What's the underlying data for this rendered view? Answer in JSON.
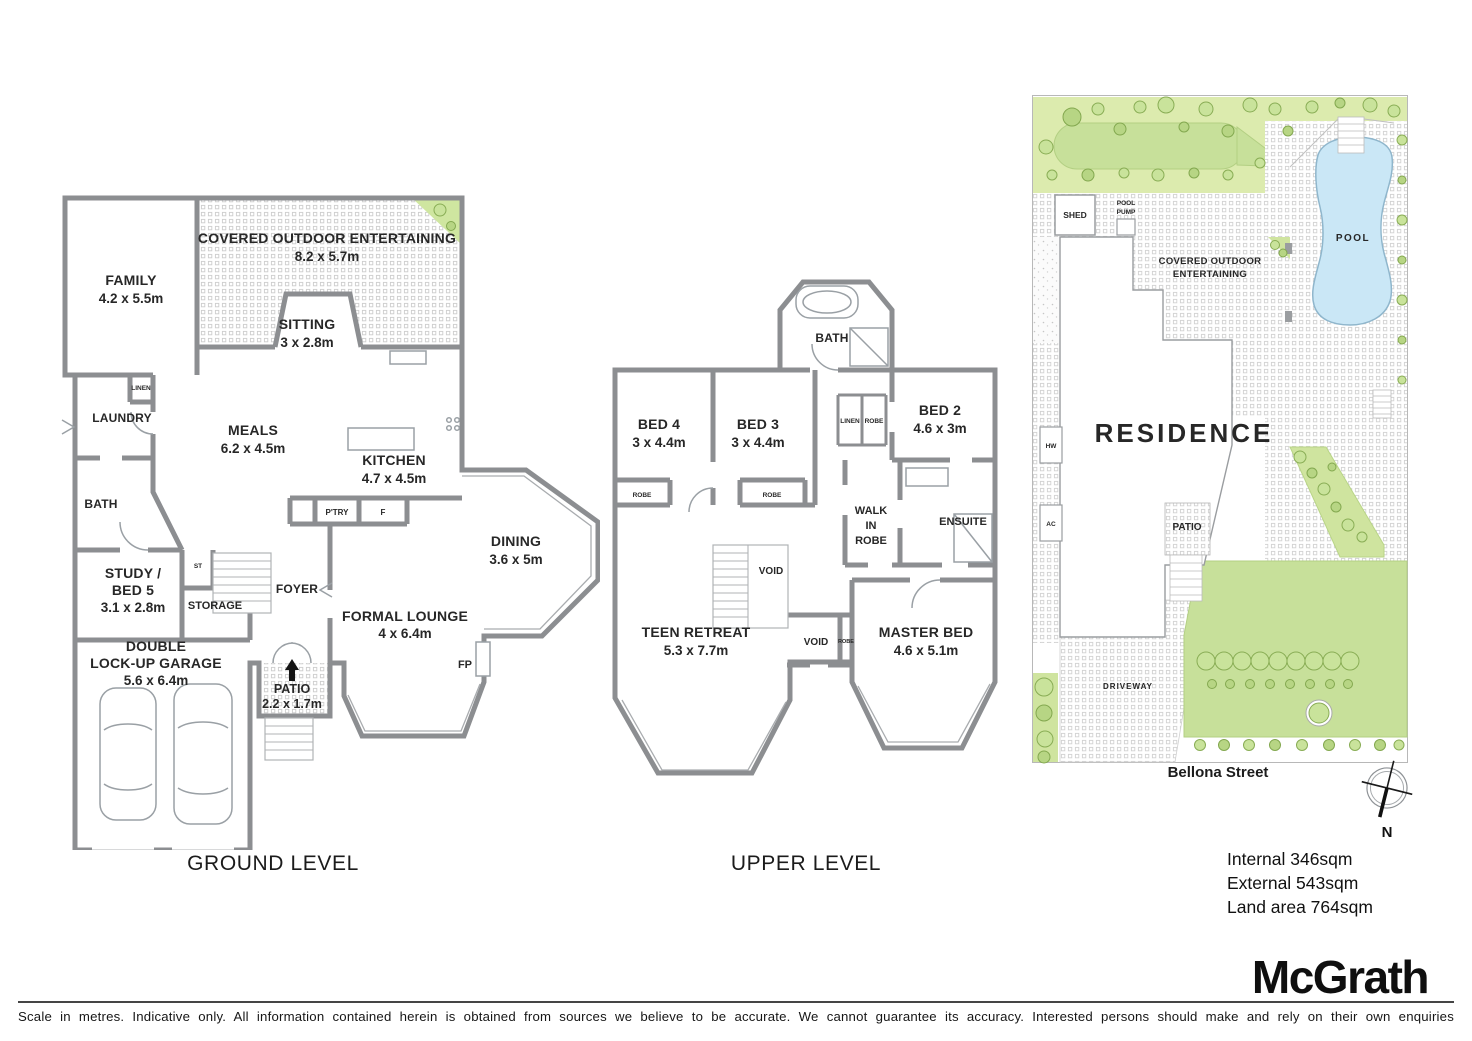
{
  "ground": {
    "title": "GROUND LEVEL",
    "rooms": {
      "family": {
        "name": "FAMILY",
        "dims": "4.2 x 5.5m"
      },
      "covered": {
        "name": "COVERED OUTDOOR ENTERTAINING",
        "dims": "8.2 x 5.7m"
      },
      "sitting": {
        "name": "SITTING",
        "dims": "3 x 2.8m"
      },
      "laundry": "LAUNDRY",
      "linen": "LINEN",
      "meals": {
        "name": "MEALS",
        "dims": "6.2 x 4.5m"
      },
      "kitchen": {
        "name": "KITCHEN",
        "dims": "4.7 x 4.5m"
      },
      "pantry": "P'TRY",
      "fridge": "F",
      "bath": "BATH",
      "study_line1": "STUDY /",
      "study_line2": "BED 5",
      "study_dims": "3.1 x 2.8m",
      "st": "ST",
      "storage": "STORAGE",
      "foyer": "FOYER",
      "lounge": {
        "name": "FORMAL LOUNGE",
        "dims": "4 x 6.4m"
      },
      "fp": "FP",
      "dining": {
        "name": "DINING",
        "dims": "3.6 x 5m"
      },
      "garage_line1": "DOUBLE",
      "garage_line2": "LOCK-UP GARAGE",
      "garage_dims": "5.6 x 6.4m",
      "patio": {
        "name": "PATIO",
        "dims": "2.2 x 1.7m"
      }
    }
  },
  "upper": {
    "title": "UPPER LEVEL",
    "rooms": {
      "bath": "BATH",
      "bed4": {
        "name": "BED 4",
        "dims": "3 x 4.4m"
      },
      "bed3": {
        "name": "BED 3",
        "dims": "3 x 4.4m"
      },
      "linen": "LINEN",
      "robe_hall": "ROBE",
      "bed2": {
        "name": "BED 2",
        "dims": "4.6 x 3m"
      },
      "robe_bed4": "ROBE",
      "robe_bed3": "ROBE",
      "wir_line1": "WALK",
      "wir_line2": "IN",
      "wir_line3": "ROBE",
      "ensuite": "ENSUITE",
      "void_stairs": "VOID",
      "teen": {
        "name": "TEEN RETREAT",
        "dims": "5.3 x 7.7m"
      },
      "void2": "VOID",
      "robe_master": "ROBE",
      "master": {
        "name": "MASTER BED",
        "dims": "4.6 x 5.1m"
      }
    }
  },
  "site": {
    "shed": "SHED",
    "pool_pump_line1": "POOL",
    "pool_pump_line2": "PUMP",
    "coe_line1": "COVERED OUTDOOR",
    "coe_line2": "ENTERTAINING",
    "pool": "POOL",
    "residence": "RESIDENCE",
    "hw": "HW",
    "ac": "AC",
    "patio": "PATIO",
    "driveway": "DRIVEWAY",
    "street": "Bellona Street"
  },
  "compass": {
    "label": "N"
  },
  "areas": {
    "internal": "Internal 346sqm",
    "external": "External 543sqm",
    "land": "Land area 764sqm"
  },
  "brand": "McGrath",
  "disclaimer": "Scale in metres. Indicative only. All information contained herein is obtained from sources we believe to be accurate. We cannot guarantee its accuracy. Interested persons should make and rely on their own enquiries",
  "colors": {
    "wall_gray": "#8c8e91",
    "pool_blue": "#cae7f6",
    "garden_light": "#dcebae",
    "lawn_green": "#c7e09a",
    "tree_stroke": "#89ad55"
  }
}
